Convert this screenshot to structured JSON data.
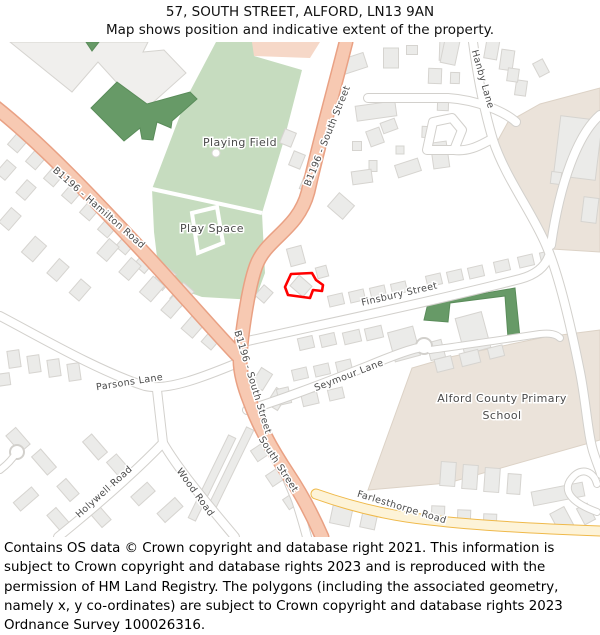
{
  "header": {
    "title": "57, SOUTH STREET, ALFORD, LN13 9AN",
    "subtitle": "Map shows position and indicative extent of the property."
  },
  "map": {
    "road_labels": {
      "b1196_south_street": "B1196 - South Street",
      "b1196_hamilton_road": "B1196 - Hamilton Road",
      "finsbury_street": "Finsbury Street",
      "seymour_lane": "Seymour Lane",
      "parsons_lane": "Parsons Lane",
      "holywell_road": "Holywell Road",
      "wood_road": "Wood Road",
      "south_street": "South Street",
      "hanby_lane": "Hanby Lane",
      "farlesthorpe_road": "Farlesthorpe Road"
    },
    "area_labels": {
      "playing_field": "Playing Field",
      "play_space": "Play Space",
      "school_line1": "Alford County Primary",
      "school_line2": "School"
    }
  },
  "colors": {
    "building": "#ebebe9",
    "buildingBig": "#f0efed",
    "buildingStroke": "#d6d4d0",
    "roadWhite": "#ffffff",
    "roadCasing": "#d2d0cc",
    "roadOrange": "#f7c9b2",
    "roadOrangeCasing": "#e9a184",
    "roadYellow": "#fdf3d8",
    "roadYellowCasing": "#efb94a",
    "greenLight": "#c6dcbf",
    "greenDark": "#679a67",
    "greenDarkStroke": "#5a8c5a",
    "beige": "#ebe3da",
    "beigeStroke": "#dcd2c6",
    "salmonPatch": "#f6d8c8",
    "labelColor": "#4a4a4a",
    "propertyRed": "#ff0000"
  },
  "footer": {
    "copyright": "Contains OS data © Crown copyright and database right 2021. This information is subject to Crown copyright and database rights 2023 and is reproduced with the permission of HM Land Registry. The polygons (including the associated geometry, namely x, y co-ordinates) are subject to Crown copyright and database rights 2023 Ordnance Survey 100026316."
  }
}
